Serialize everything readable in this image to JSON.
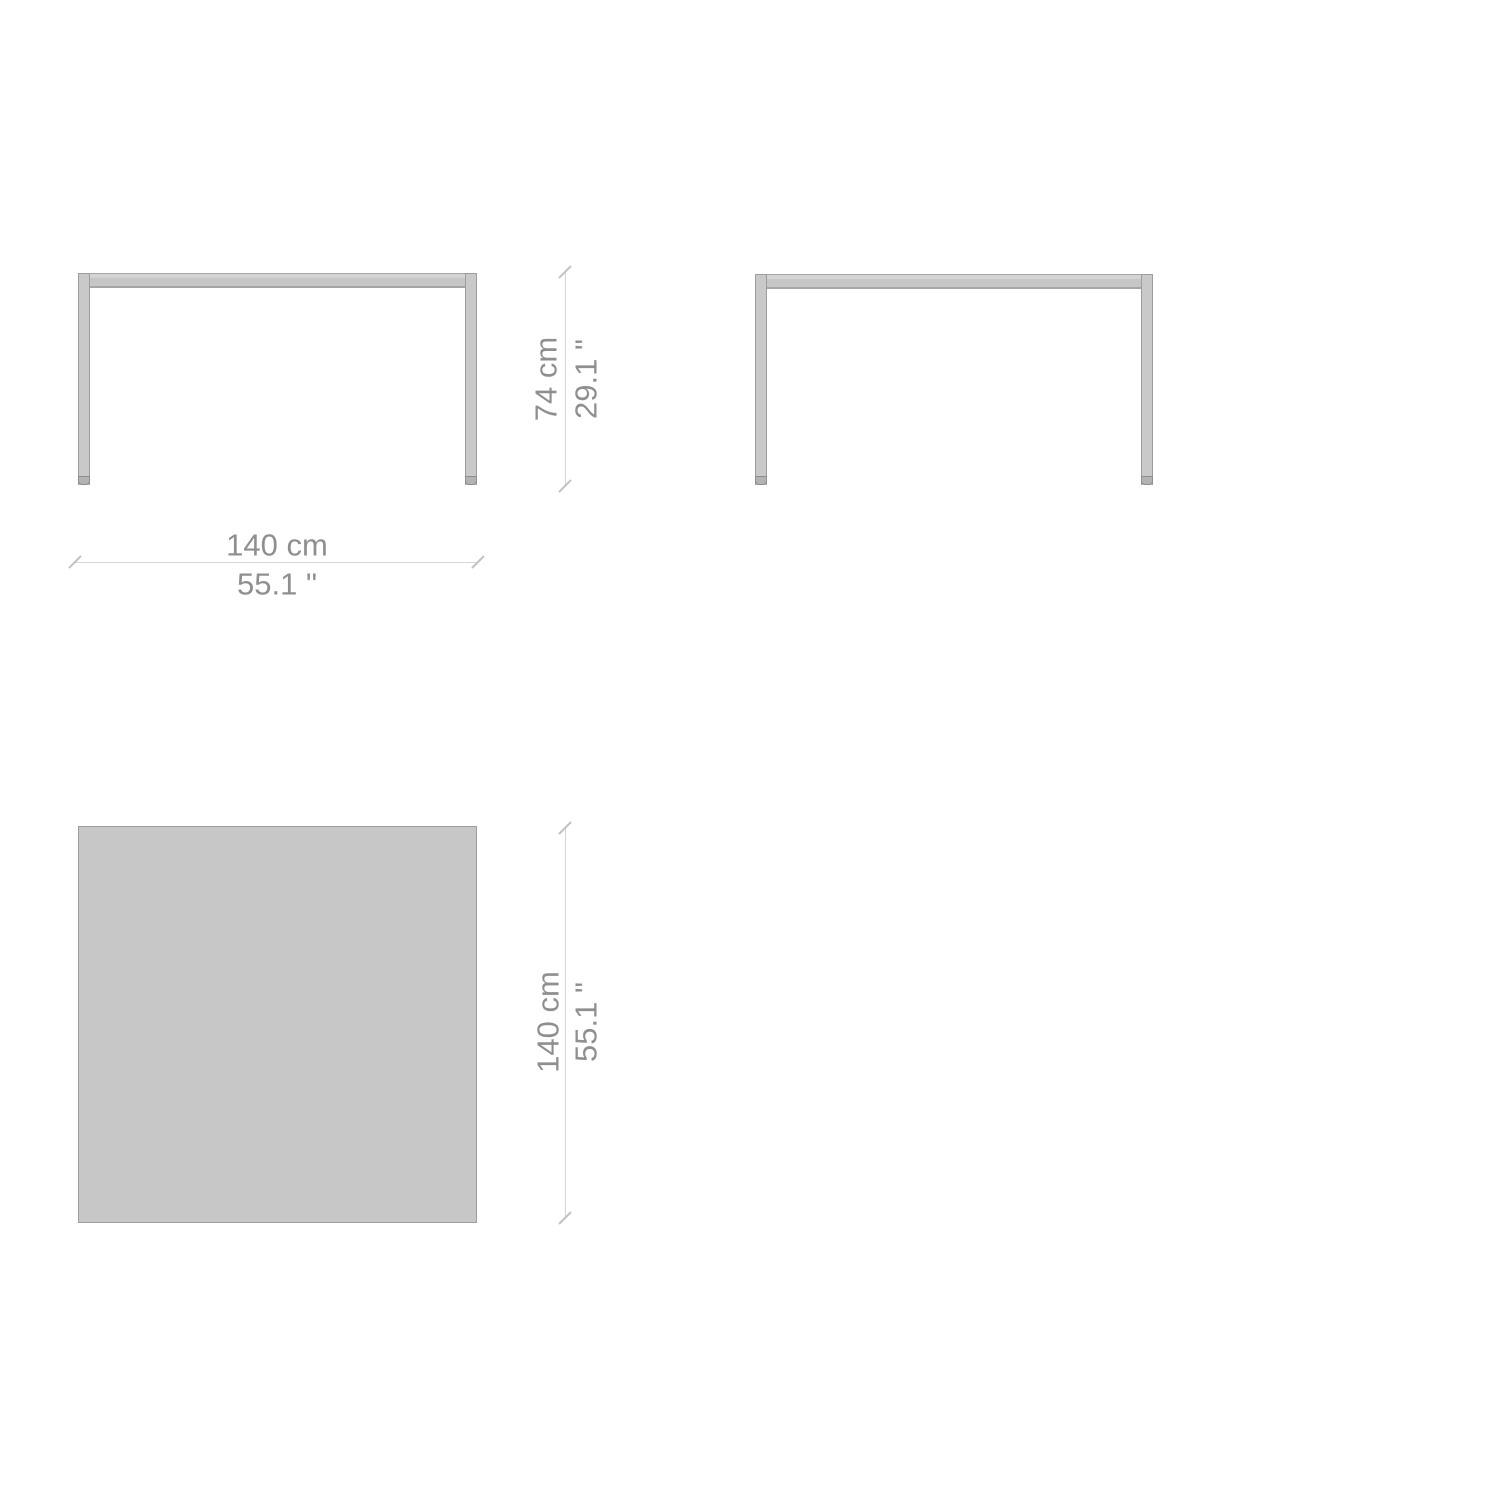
{
  "drawing": {
    "kind": "table-dimension-drawing",
    "views": [
      "front-elevation",
      "side-elevation",
      "plan"
    ]
  },
  "dimensions": {
    "front_height_metric": "74 cm",
    "front_height_imperial": "29.1 \"",
    "front_width_metric": "140 cm",
    "front_width_imperial": "55.1 \"",
    "plan_depth_metric": "140 cm",
    "plan_depth_imperial": "55.1 \""
  },
  "colors": {
    "background": "#ffffff",
    "surface_fill": "#c7c7c7",
    "surface_border": "#9d9d9d",
    "leg_fill": "#c9c9c9",
    "foot_fill": "#b3b3b3",
    "dimension_line": "#d6d6d6",
    "dimension_tick": "#c2c2c2",
    "dimension_text": "#8f8f8f"
  }
}
